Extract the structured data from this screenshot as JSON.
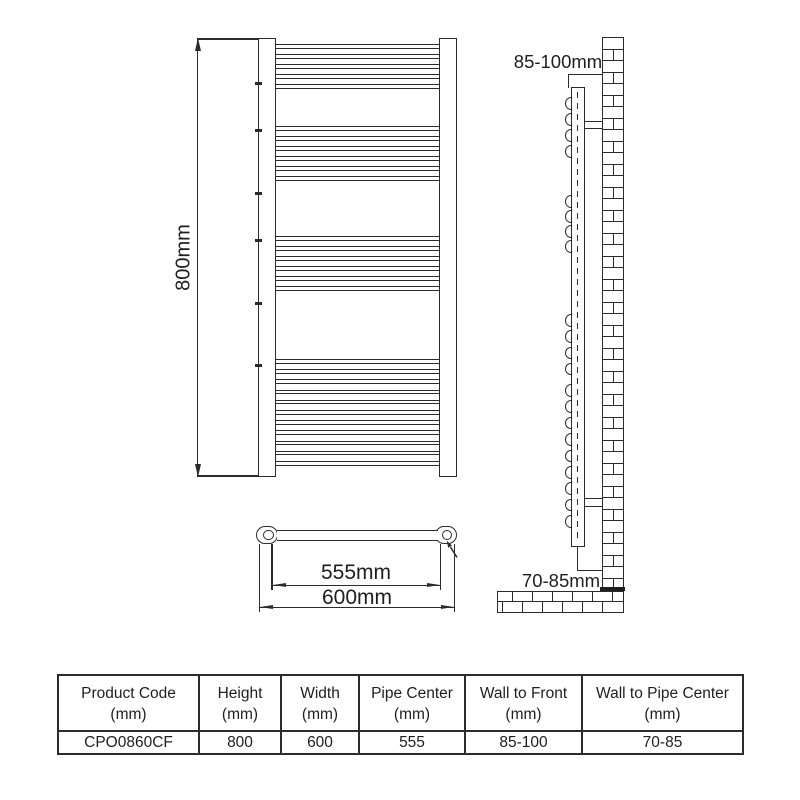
{
  "diagram": {
    "front_view": {
      "height_label": "800mm",
      "bar_groups": [
        {
          "y": 44,
          "count": 5,
          "spacing": 10
        },
        {
          "y": 126,
          "count": 6,
          "spacing": 10
        },
        {
          "y": 236,
          "count": 6,
          "spacing": 10
        },
        {
          "y": 359,
          "count": 11,
          "spacing": 10.2
        }
      ],
      "rail_ticks": [
        82,
        129,
        192,
        239,
        302,
        364
      ]
    },
    "side_view": {
      "wall_to_front_label": "85-100mm",
      "wall_to_pipe_label": "70-85mm",
      "bump_groups": [
        {
          "y": 97,
          "count": 4,
          "spacing": 16
        },
        {
          "y": 195,
          "count": 4,
          "spacing": 15
        },
        {
          "y": 314,
          "count": 4,
          "spacing": 16.3
        },
        {
          "y": 384,
          "count": 9,
          "spacing": 16.4
        }
      ],
      "wall_rows": 48,
      "floor_rows": [
        {
          "offsets": [
            15,
            20,
            20,
            20,
            20,
            20
          ]
        },
        {
          "offsets": [
            5,
            20,
            20,
            20,
            20,
            20
          ]
        }
      ]
    },
    "top_view": {
      "pipe_center_label": "555mm",
      "width_label": "600mm"
    }
  },
  "spec_table": {
    "columns": [
      {
        "title": "Product Code",
        "unit": "(mm)"
      },
      {
        "title": "Height",
        "unit": "(mm)"
      },
      {
        "title": "Width",
        "unit": "(mm)"
      },
      {
        "title": "Pipe Center",
        "unit": "(mm)"
      },
      {
        "title": "Wall to Front",
        "unit": "(mm)"
      },
      {
        "title": "Wall to Pipe Center",
        "unit": "(mm)"
      }
    ],
    "row": {
      "product_code": "CPO0860CF",
      "height": "800",
      "width": "600",
      "pipe_center": "555",
      "wall_to_front": "85-100",
      "wall_to_pipe_center": "70-85"
    }
  },
  "colors": {
    "line": "#2b2b2b",
    "background": "#ffffff"
  }
}
